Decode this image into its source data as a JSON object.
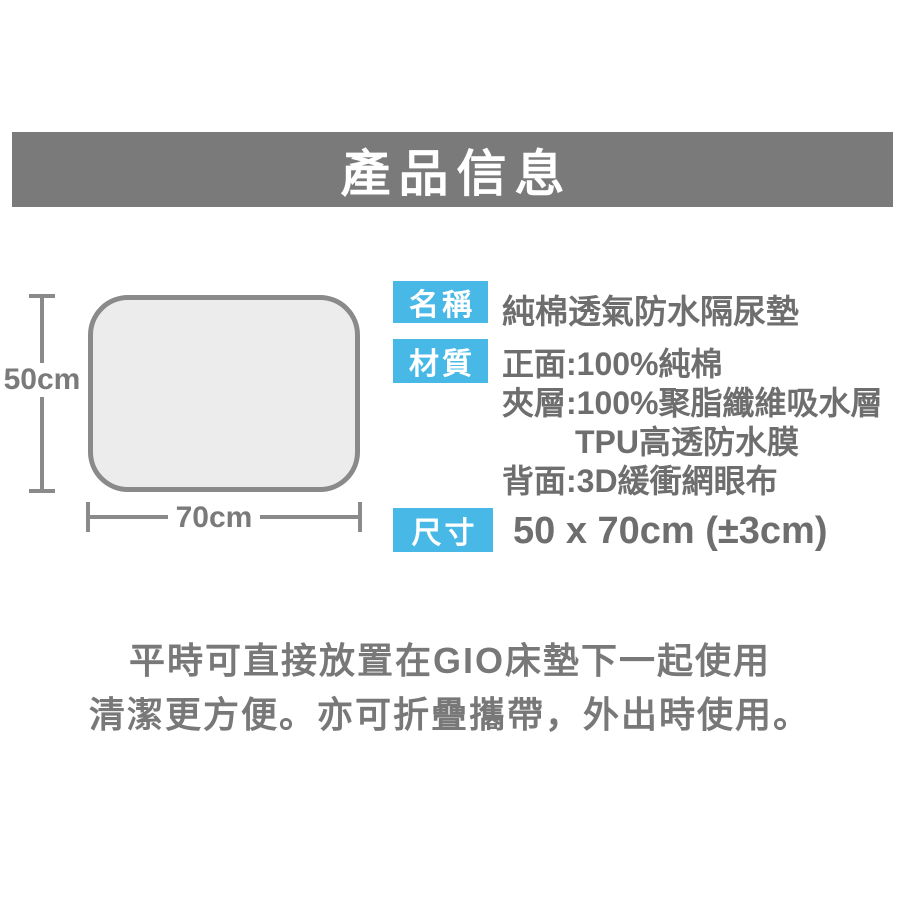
{
  "header": {
    "title": "產品信息"
  },
  "diagram": {
    "height_label": "50cm",
    "width_label": "70cm"
  },
  "specs": {
    "name": {
      "label": "名稱",
      "value": "純棉透氣防水隔尿墊"
    },
    "material": {
      "label": "材質",
      "line1": "正面:100%純棉",
      "line2": "夾層:100%聚脂纖維吸水層",
      "line3": "TPU高透防水膜",
      "line4": "背面:3D緩衝網眼布"
    },
    "size": {
      "label": "尺寸",
      "value": "50 x 70cm (±3cm)"
    }
  },
  "footer": {
    "line1": "平時可直接放置在GIO床墊下一起使用",
    "line2": "清潔更方便。亦可折疊攜帶，外出時使用。"
  },
  "colors": {
    "banner_gray": "#7a7a7a",
    "accent_blue": "#48b8e6",
    "text_gray": "#6e6e6e",
    "mat_fill": "#ececec",
    "line_gray": "#8a8a8a"
  }
}
